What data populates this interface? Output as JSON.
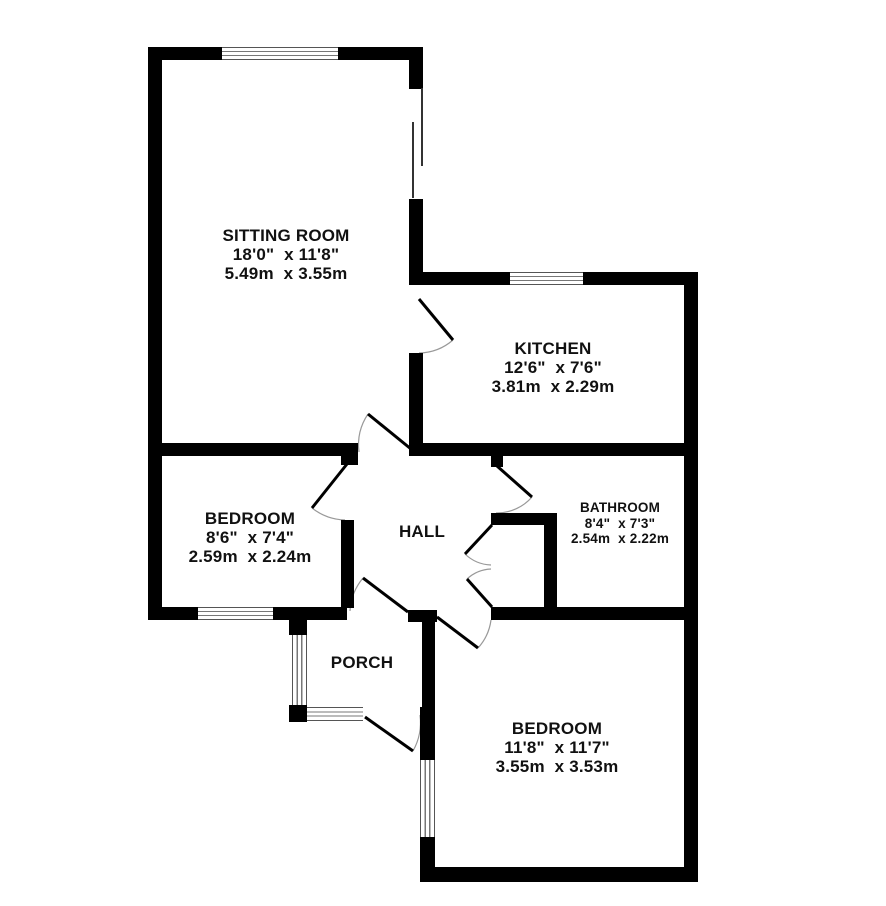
{
  "floorplan": {
    "background": "#ffffff",
    "wall_color": "#000000",
    "window_frame_color": "#555555",
    "door_arc_color": "#999999",
    "rooms": [
      {
        "id": "sitting-room",
        "size": "lg",
        "cx": 286,
        "top": 226,
        "lines": [
          "SITTING ROOM",
          "18'0\"  x 11'8\"",
          "5.49m  x 3.55m"
        ]
      },
      {
        "id": "kitchen",
        "size": "lg",
        "cx": 553,
        "top": 339,
        "lines": [
          "KITCHEN",
          "12'6\"  x 7'6\"",
          "3.81m  x 2.29m"
        ]
      },
      {
        "id": "bedroom-1",
        "size": "lg",
        "cx": 250,
        "top": 509,
        "lines": [
          "BEDROOM",
          "8'6\"  x 7'4\"",
          "2.59m  x 2.24m"
        ]
      },
      {
        "id": "hall",
        "size": "lg",
        "cx": 422,
        "top": 522,
        "lines": [
          "HALL"
        ]
      },
      {
        "id": "bathroom",
        "size": "sm",
        "cx": 620,
        "top": 500,
        "lines": [
          "BATHROOM",
          "8'4\"  x 7'3\"",
          "2.54m  x 2.22m"
        ]
      },
      {
        "id": "porch",
        "size": "lg",
        "cx": 362,
        "top": 653,
        "lines": [
          "PORCH"
        ]
      },
      {
        "id": "bedroom-2",
        "size": "lg",
        "cx": 557,
        "top": 719,
        "lines": [
          "BEDROOM",
          "11'8\"  x 11'7\"",
          "3.55m  x 3.53m"
        ]
      }
    ],
    "walls": [
      [
        148,
        47,
        74,
        13
      ],
      [
        338,
        47,
        81,
        13
      ],
      [
        148,
        47,
        14,
        573
      ],
      [
        409,
        47,
        14,
        42
      ],
      [
        409,
        199,
        14,
        86
      ],
      [
        419,
        272,
        91,
        13
      ],
      [
        583,
        272,
        115,
        13
      ],
      [
        684,
        272,
        14,
        610
      ],
      [
        148,
        443,
        210,
        13
      ],
      [
        341,
        443,
        17,
        22
      ],
      [
        409,
        353,
        14,
        102
      ],
      [
        409,
        443,
        275,
        13
      ],
      [
        491,
        455,
        12,
        12
      ],
      [
        341,
        520,
        13,
        88
      ],
      [
        148,
        607,
        50,
        13
      ],
      [
        273,
        607,
        74,
        13
      ],
      [
        408,
        610,
        29,
        12
      ],
      [
        422,
        620,
        13,
        87
      ],
      [
        420,
        707,
        15,
        53
      ],
      [
        420,
        837,
        15,
        31
      ],
      [
        420,
        867,
        278,
        15
      ],
      [
        491,
        607,
        193,
        13
      ],
      [
        491,
        513,
        66,
        12
      ],
      [
        544,
        513,
        13,
        95
      ],
      [
        289,
        620,
        18,
        15
      ],
      [
        289,
        705,
        18,
        17
      ]
    ],
    "windows": [
      {
        "rect": [
          222,
          47,
          116,
          13
        ],
        "orient": "h"
      },
      {
        "rect": [
          510,
          272,
          73,
          13
        ],
        "orient": "h"
      },
      {
        "rect": [
          198,
          607,
          75,
          13
        ],
        "orient": "h"
      },
      {
        "rect": [
          292,
          635,
          15,
          70
        ],
        "orient": "v"
      },
      {
        "rect": [
          307,
          707,
          56,
          14
        ],
        "orient": "h"
      },
      {
        "rect": [
          420,
          760,
          15,
          77
        ],
        "orient": "v"
      }
    ],
    "sliding_door_lines": [
      [
        421,
        88,
        2,
        78
      ],
      [
        412,
        122,
        2,
        76
      ]
    ],
    "doors": [
      {
        "name": "sitting-room-door",
        "hinge": [
          411,
          449
        ],
        "tip": [
          368,
          414
        ],
        "end": [
          359,
          452
        ]
      },
      {
        "name": "kitchen-door",
        "hinge": [
          419,
          299
        ],
        "tip": [
          453,
          340
        ],
        "end": [
          419,
          353
        ]
      },
      {
        "name": "bedroom-1-door",
        "hinge": [
          347,
          464
        ],
        "tip": [
          312,
          508
        ],
        "end": [
          345,
          520
        ]
      },
      {
        "name": "bathroom-door",
        "hinge": [
          497,
          466
        ],
        "tip": [
          532,
          497
        ],
        "end": [
          496,
          513
        ]
      },
      {
        "name": "cupboard-door-top",
        "hinge": [
          492,
          525
        ],
        "tip": [
          465,
          554
        ],
        "end": [
          491,
          565
        ]
      },
      {
        "name": "cupboard-door-bottom",
        "hinge": [
          492,
          607
        ],
        "tip": [
          467,
          579
        ],
        "end": [
          491,
          569
        ]
      },
      {
        "name": "porch-inner-door",
        "hinge": [
          408,
          612
        ],
        "tip": [
          363,
          578
        ],
        "end": [
          350,
          611
        ]
      },
      {
        "name": "bedroom-2-door",
        "hinge": [
          437,
          617
        ],
        "tip": [
          478,
          648
        ],
        "end": [
          491,
          620
        ]
      },
      {
        "name": "porch-entrance-door",
        "hinge": [
          365,
          717
        ],
        "tip": [
          413,
          751
        ],
        "end": [
          420,
          715
        ]
      }
    ]
  }
}
